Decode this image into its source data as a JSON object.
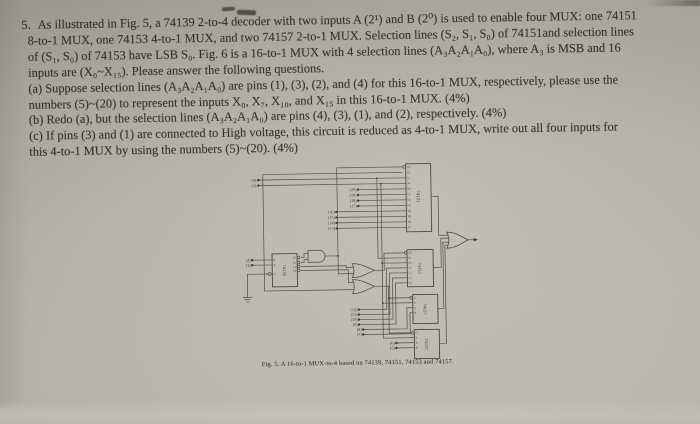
{
  "colors": {
    "paper_top": "#a7a39d",
    "paper_mid": "#c0bdb6",
    "paper_bottom": "#cdcac3",
    "ink": "#322e27",
    "wire": "#4b4740"
  },
  "question": {
    "number": "5.",
    "lines": [
      "As illustrated in Fig. 5, a 74139 2-to-4 decoder with two inputs A (2¹) and B (2⁰) is used to enable four MUX: one 74151",
      "8-to-1 MUX, one 74153 4-to-1 MUX, and two 74157 2-to-1 MUX. Selection lines (S₂, S₁, S₀) of 74151and selection lines",
      "of (S₁, S₀) of 74153 have LSB S₀. Fig. 6 is a 16-to-1 MUX with 4 selection lines (A₃A₂A₁A₀), where A₃ is MSB and 16",
      "inputs are (X₀~X₁₅). Please answer the following questions.",
      "(a) Suppose selection lines (A₃A₂A₁A₀) are pins (1), (3), (2), and (4) for this 16-to-1 MUX, respectively, please use the",
      "numbers (5)~(20) to represent the inputs X₀, X₇, X₁₀, and X₁₅ in this 16-to-1 MUX. (4%)",
      "(b) Redo (a), but the selection lines (A₃A₂A₁A₀) are pins (4), (3), (1), and (2), respectively. (4%)",
      "(c) If pins (3) and (1) are connected to High voltage, this circuit is reduced as 4-to-1 MUX, write out all four inputs for",
      "this 4-to-1 MUX by using the numbers (5)~(20). (4%)"
    ]
  },
  "figure": {
    "caption": "Fig. 5. A 16-to-1 MUX-to-4 based on 74139, 74151, 74153 and 74157.",
    "chips": {
      "mux8": {
        "name": "74151",
        "pins": [
          "EN",
          "S2",
          "S1",
          "S0",
          "D0",
          "D1",
          "D2",
          "D3",
          "D4",
          "D5",
          "D6",
          "D7"
        ]
      },
      "decoder": {
        "name": "74139",
        "pins_left": [
          "B",
          "A",
          "G"
        ],
        "pins_right": [
          "Y0",
          "Y1",
          "Y2",
          "Y3"
        ]
      },
      "mux4": {
        "name": "74153",
        "pins": [
          "EN",
          "S1",
          "S0",
          "C0",
          "C1",
          "C2",
          "C3"
        ]
      },
      "mux2a": {
        "name": "74157",
        "pins": [
          "G",
          "S",
          "A",
          "B"
        ]
      },
      "mux2b": {
        "name": "74157",
        "pins": [
          "G",
          "S",
          "A",
          "B"
        ]
      }
    },
    "inputs": {
      "select": [
        "(4)",
        "(3)"
      ],
      "decoder": [
        "(2)",
        "(1)"
      ],
      "mux8": [
        "(20)",
        "(19)",
        "(18)",
        "(17)",
        "(16)",
        "(15)",
        "(14)",
        "(13)"
      ],
      "mux4": [
        "(12)",
        "(11)",
        "(10)",
        "(9)"
      ],
      "mux2a": [
        "(8)",
        "(7)"
      ],
      "mux2b": [
        "(6)",
        "(5)"
      ]
    }
  }
}
